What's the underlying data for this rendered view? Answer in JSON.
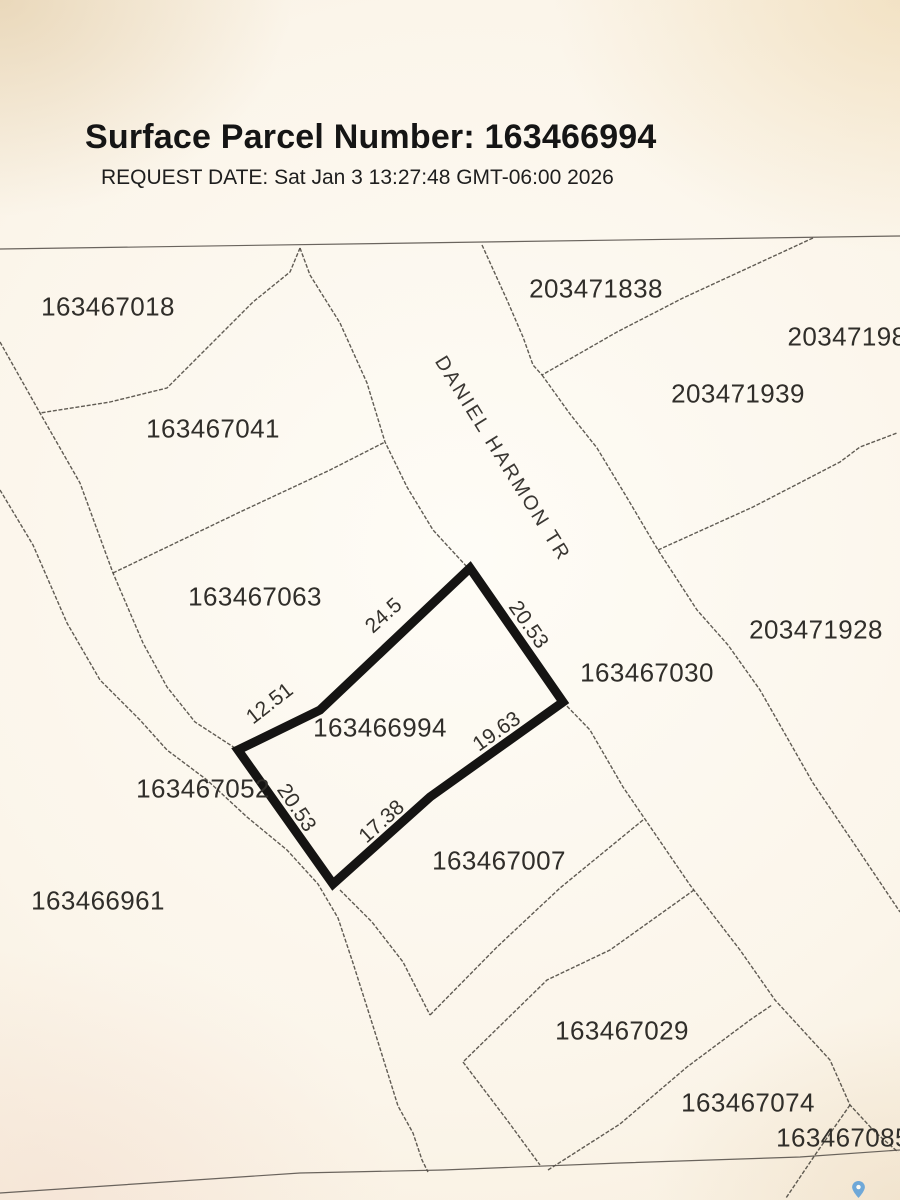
{
  "header": {
    "title": "Surface Parcel Number: 163466994",
    "request_line": "REQUEST DATE: Sat Jan 3 13:27:48 GMT-06:00 2026"
  },
  "map": {
    "colors": {
      "boundary_line": "#4a463e",
      "subject_outline": "#151413",
      "paper": "#f8f1e2",
      "pin_blue": "#6fa8d8"
    },
    "subject_parcel": {
      "number": "163466994",
      "polygon": [
        [
          470,
          568
        ],
        [
          563,
          702
        ],
        [
          430,
          797
        ],
        [
          333,
          884
        ],
        [
          238,
          750
        ],
        [
          320,
          710
        ]
      ]
    },
    "street": {
      "text": "DANIEL HARMON TR",
      "x": 502,
      "y": 459,
      "angle": 58
    },
    "parcel_labels": [
      {
        "text": "163467018",
        "x": 108,
        "y": 307
      },
      {
        "text": "163467041",
        "x": 213,
        "y": 429
      },
      {
        "text": "203471838",
        "x": 596,
        "y": 289
      },
      {
        "text": "20347198",
        "x": 847,
        "y": 337
      },
      {
        "text": "203471939",
        "x": 738,
        "y": 394
      },
      {
        "text": "163467063",
        "x": 255,
        "y": 597
      },
      {
        "text": "203471928",
        "x": 816,
        "y": 630
      },
      {
        "text": "163467030",
        "x": 647,
        "y": 673
      },
      {
        "text": "163466994",
        "x": 380,
        "y": 728
      },
      {
        "text": "163467052",
        "x": 203,
        "y": 789
      },
      {
        "text": "163466961",
        "x": 98,
        "y": 901
      },
      {
        "text": "163467007",
        "x": 499,
        "y": 861
      },
      {
        "text": "163467029",
        "x": 622,
        "y": 1031
      },
      {
        "text": "163467074",
        "x": 748,
        "y": 1103
      },
      {
        "text": "163467085",
        "x": 843,
        "y": 1138
      }
    ],
    "dimensions": [
      {
        "text": "24.5",
        "x": 384,
        "y": 616,
        "angle": -42
      },
      {
        "text": "12.51",
        "x": 270,
        "y": 704,
        "angle": -38
      },
      {
        "text": "20.53",
        "x": 528,
        "y": 625,
        "angle": 55
      },
      {
        "text": "19.63",
        "x": 497,
        "y": 732,
        "angle": -35
      },
      {
        "text": "17.38",
        "x": 382,
        "y": 822,
        "angle": -42
      },
      {
        "text": "20.53",
        "x": 296,
        "y": 808,
        "angle": 56
      }
    ],
    "boundaries": [
      {
        "id": "map-top-edge",
        "solid": true,
        "points": [
          [
            0,
            249
          ],
          [
            900,
            236
          ]
        ]
      },
      {
        "id": "bdy-018-041",
        "solid": false,
        "points": [
          [
            300,
            248
          ],
          [
            290,
            272
          ],
          [
            253,
            302
          ],
          [
            167,
            388
          ],
          [
            110,
            402
          ],
          [
            40,
            413
          ]
        ]
      },
      {
        "id": "creek-west",
        "solid": false,
        "points": [
          [
            0,
            490
          ],
          [
            33,
            545
          ],
          [
            67,
            623
          ],
          [
            100,
            680
          ],
          [
            140,
            720
          ],
          [
            167,
            750
          ],
          [
            207,
            780
          ],
          [
            247,
            817
          ],
          [
            287,
            850
          ],
          [
            318,
            884
          ],
          [
            338,
            918
          ],
          [
            353,
            963
          ],
          [
            373,
            1026
          ],
          [
            398,
            1106
          ],
          [
            413,
            1133
          ],
          [
            422,
            1160
          ],
          [
            428,
            1172
          ]
        ]
      },
      {
        "id": "creek-east",
        "solid": false,
        "points": [
          [
            0,
            342
          ],
          [
            40,
            413
          ],
          [
            80,
            483
          ],
          [
            113,
            573
          ],
          [
            143,
            643
          ],
          [
            167,
            687
          ],
          [
            195,
            722
          ],
          [
            238,
            750
          ]
        ]
      },
      {
        "id": "bdy-041-063",
        "solid": false,
        "points": [
          [
            113,
            573
          ],
          [
            240,
            512
          ],
          [
            330,
            470
          ],
          [
            385,
            442
          ]
        ]
      },
      {
        "id": "street-west",
        "solid": false,
        "points": [
          [
            300,
            248
          ],
          [
            310,
            275
          ],
          [
            340,
            323
          ],
          [
            367,
            383
          ],
          [
            385,
            442
          ],
          [
            407,
            487
          ],
          [
            433,
            530
          ],
          [
            468,
            568
          ]
        ]
      },
      {
        "id": "street-east-upper",
        "solid": false,
        "points": [
          [
            482,
            245
          ],
          [
            507,
            300
          ],
          [
            523,
            337
          ],
          [
            533,
            365
          ],
          [
            542,
            375
          ]
        ]
      },
      {
        "id": "bdy-838-939",
        "solid": false,
        "points": [
          [
            813,
            238
          ],
          [
            683,
            298
          ],
          [
            617,
            332
          ],
          [
            542,
            375
          ]
        ]
      },
      {
        "id": "street-east-lower",
        "solid": false,
        "points": [
          [
            542,
            375
          ],
          [
            570,
            414
          ],
          [
            597,
            448
          ],
          [
            626,
            496
          ],
          [
            658,
            550
          ],
          [
            697,
            610
          ],
          [
            728,
            645
          ],
          [
            760,
            690
          ],
          [
            813,
            783
          ],
          [
            857,
            848
          ],
          [
            900,
            912
          ]
        ]
      },
      {
        "id": "bdy-939-928",
        "solid": false,
        "points": [
          [
            658,
            550
          ],
          [
            753,
            507
          ],
          [
            840,
            462
          ],
          [
            860,
            447
          ],
          [
            897,
            433
          ]
        ]
      },
      {
        "id": "east-block-west",
        "solid": false,
        "points": [
          [
            563,
            702
          ],
          [
            590,
            730
          ],
          [
            623,
            787
          ],
          [
            690,
            885
          ],
          [
            740,
            950
          ],
          [
            775,
            1000
          ],
          [
            830,
            1060
          ],
          [
            850,
            1105
          ],
          [
            875,
            1132
          ],
          [
            898,
            1152
          ]
        ]
      },
      {
        "id": "bdy-007-029",
        "solid": false,
        "points": [
          [
            643,
            820
          ],
          [
            560,
            888
          ],
          [
            497,
            947
          ],
          [
            430,
            1015
          ]
        ]
      },
      {
        "id": "bdy-007-sw",
        "solid": false,
        "points": [
          [
            340,
            890
          ],
          [
            372,
            922
          ],
          [
            403,
            962
          ],
          [
            430,
            1015
          ]
        ]
      },
      {
        "id": "bdy-029-nw",
        "solid": false,
        "points": [
          [
            694,
            890
          ],
          [
            610,
            950
          ],
          [
            547,
            980
          ],
          [
            463,
            1062
          ]
        ]
      },
      {
        "id": "bdy-029-sw",
        "solid": false,
        "points": [
          [
            463,
            1062
          ],
          [
            507,
            1120
          ],
          [
            540,
            1165
          ]
        ]
      },
      {
        "id": "bdy-029-se",
        "solid": false,
        "points": [
          [
            548,
            1170
          ],
          [
            620,
            1124
          ],
          [
            687,
            1067
          ],
          [
            750,
            1020
          ],
          [
            772,
            1005
          ]
        ]
      },
      {
        "id": "bdy-074-085",
        "solid": false,
        "points": [
          [
            850,
            1105
          ],
          [
            815,
            1155
          ],
          [
            786,
            1198
          ]
        ]
      },
      {
        "id": "map-bottom-edge",
        "solid": true,
        "points": [
          [
            0,
            1193
          ],
          [
            150,
            1183
          ],
          [
            300,
            1173
          ],
          [
            443,
            1170
          ],
          [
            620,
            1163
          ],
          [
            800,
            1157
          ],
          [
            900,
            1150
          ]
        ]
      }
    ],
    "pin": {
      "x": 852,
      "y": 1181
    }
  }
}
